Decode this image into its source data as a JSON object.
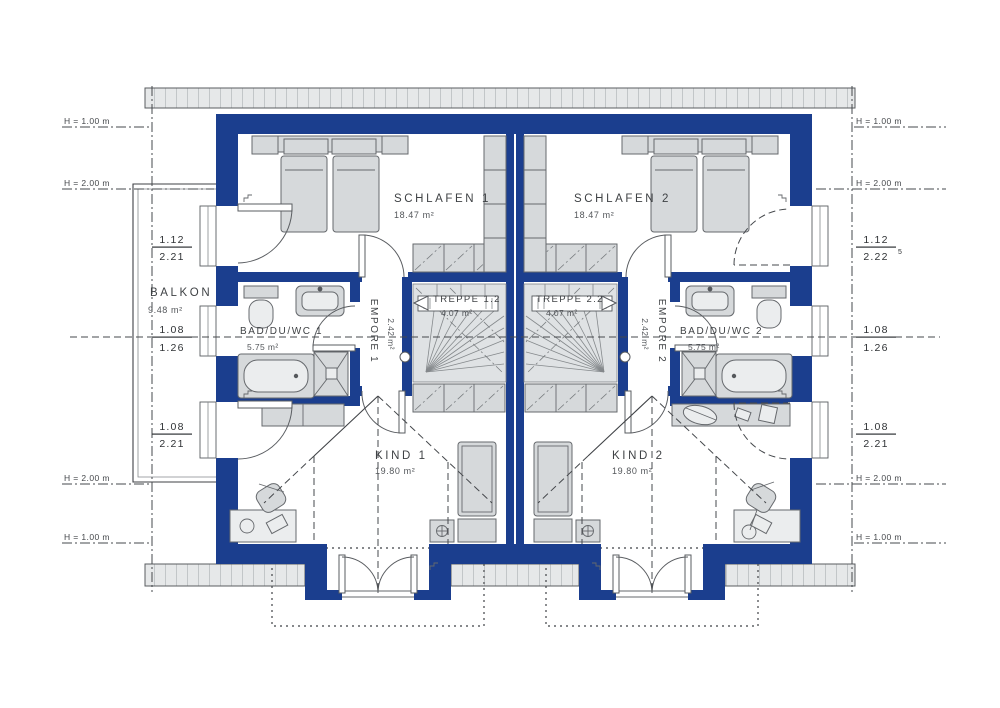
{
  "colors": {
    "wall_blue": "#1b3e8e",
    "furniture_gray": "#d6d9db",
    "hatch_gray": "#e6e8e9",
    "line_dark": "#45484c"
  },
  "rooms": {
    "schlafen1": {
      "name": "SCHLAFEN 1",
      "area": "18.47 m²"
    },
    "schlafen2": {
      "name": "SCHLAFEN 2",
      "area": "18.47 m²"
    },
    "treppe1": {
      "name": "TREPPE 1.2",
      "area": "4.07 m²"
    },
    "treppe2": {
      "name": "TREPPE 2.2",
      "area": "4.07 m²"
    },
    "empore1": {
      "name": "EMPORE 1",
      "area": "2.42 m²"
    },
    "empore2": {
      "name": "EMPORE 2",
      "area": "2.42 m²"
    },
    "bad1": {
      "name": "BAD/DU/WC 1",
      "area": "5.75 m²"
    },
    "bad2": {
      "name": "BAD/DU/WC 2",
      "area": "5.75 m²"
    },
    "kind1": {
      "name": "KIND 1",
      "area": "19.80 m²"
    },
    "kind2": {
      "name": "KIND 2",
      "area": "19.80 m²"
    },
    "balkon": {
      "name": "BALKON",
      "area": "9.48 m²"
    }
  },
  "dimensions": {
    "left": {
      "door_schlafen": {
        "num": "1.12",
        "den": "2.21"
      },
      "window_bad": {
        "num": "1.08",
        "den": "1.26"
      },
      "door_kind": {
        "num": "1.08",
        "den": "2.21"
      }
    },
    "right": {
      "window_schlafen": {
        "num": "1.12",
        "den": "2.22",
        "sup": "5"
      },
      "window_bad": {
        "num": "1.08",
        "den": "1.26"
      },
      "window_kind": {
        "num": "1.08",
        "den": "2.21"
      }
    }
  },
  "height_marks": {
    "left": [
      "H = 1.00 m",
      "H = 2.00 m",
      "H = 2.00 m",
      "H = 1.00 m"
    ],
    "right": [
      "H = 1.00 m",
      "H = 2.00 m",
      "H = 2.00 m",
      "H = 1.00 m"
    ]
  }
}
